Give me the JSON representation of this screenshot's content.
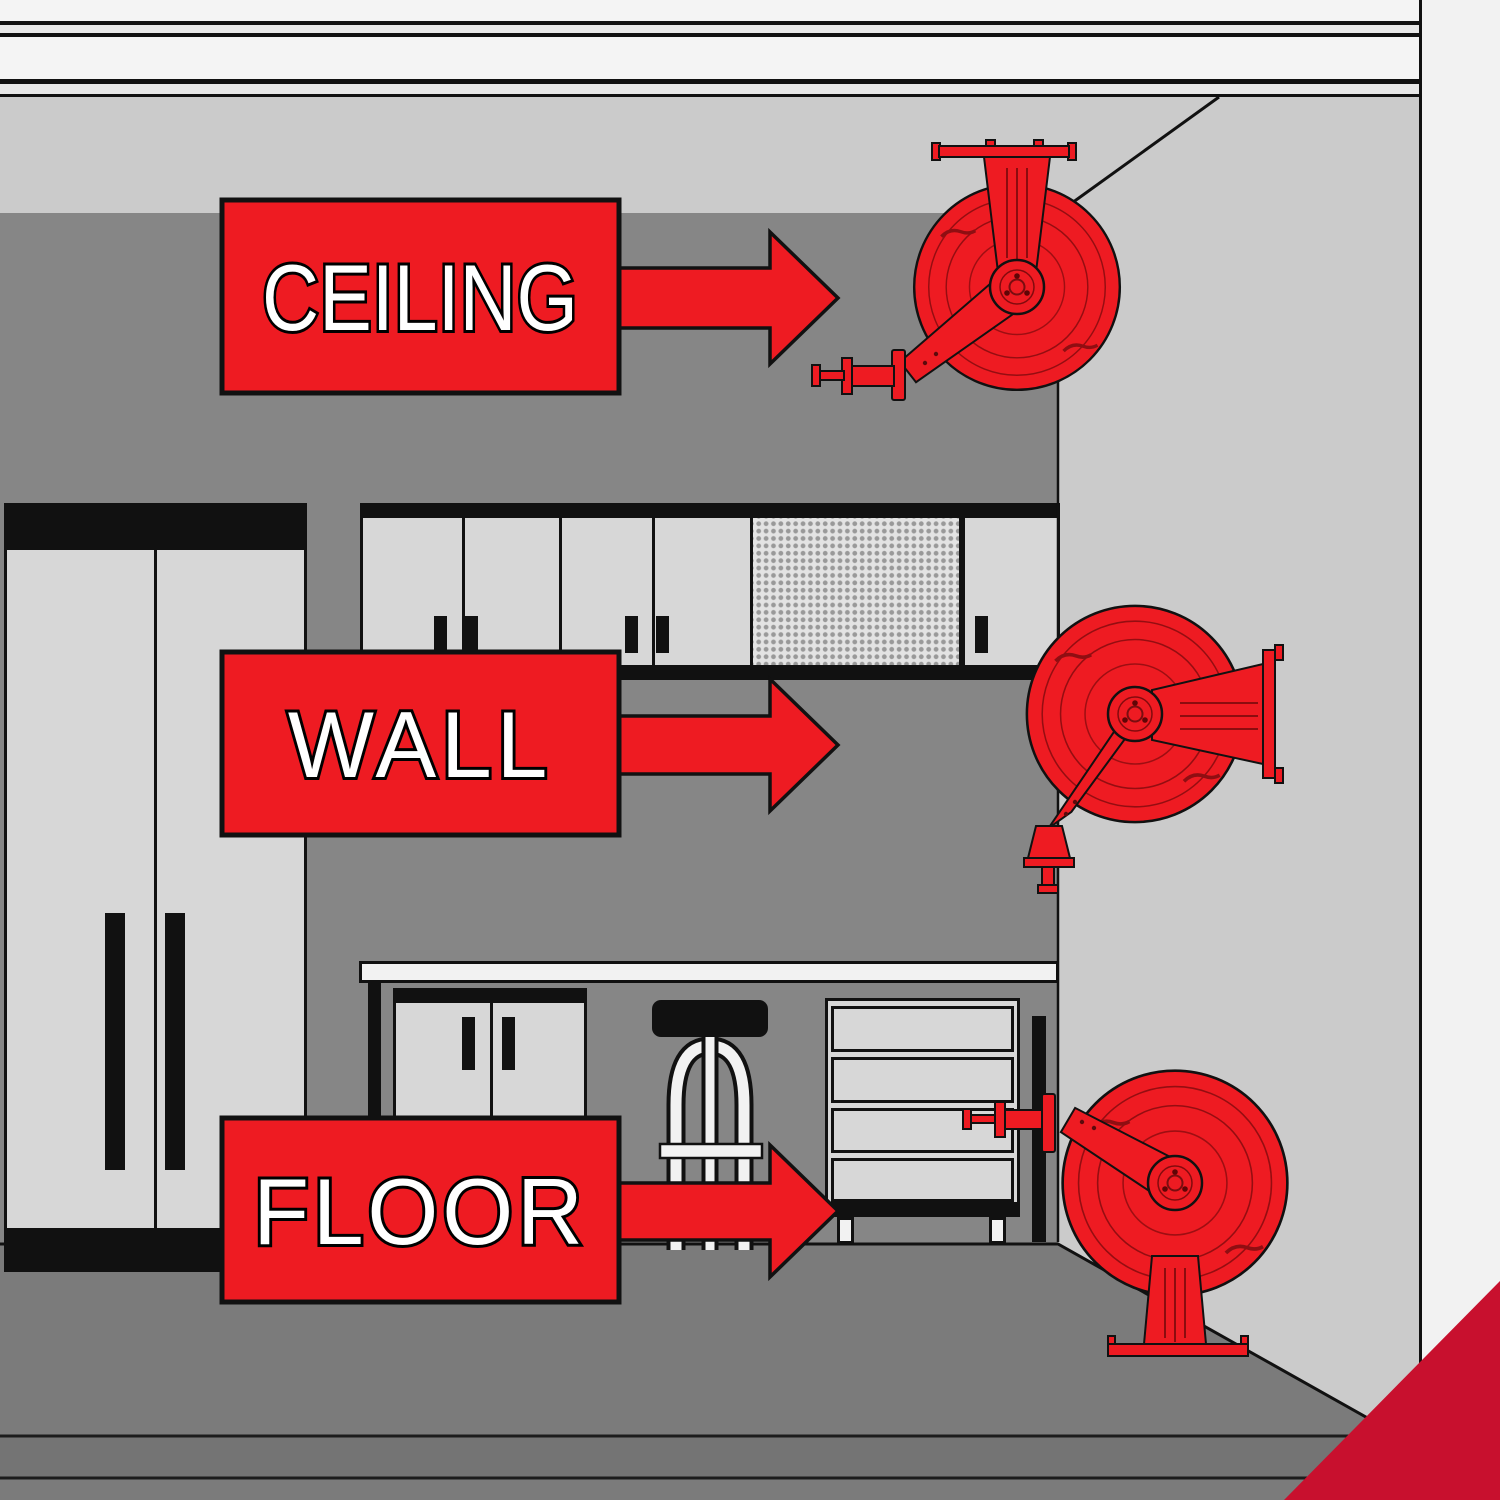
{
  "page": {
    "type": "product-mounting-illustration",
    "subject": "Garage hose reel mounting positions"
  },
  "labels": {
    "ceiling": {
      "text": "CEILING"
    },
    "wall": {
      "text": "WALL"
    },
    "floor": {
      "text": "FLOOR"
    }
  },
  "icons": {
    "ceiling_reel": "hose-reel-ceiling-mount",
    "wall_reel": "hose-reel-wall-mount",
    "floor_reel": "hose-reel-floor-mount",
    "arrow": "arrow-right"
  },
  "colors": {
    "label_red": "#ee1b22",
    "corner_accent_red": "#c8102e",
    "back_wall_gray": "#868686",
    "side_wall_gray": "#cbcbcb",
    "floor_gray": "#7b7b7b",
    "cabinet_gray": "#d7d7d7",
    "pegboard_gray": "#e3e3e3",
    "countertop_white": "#f2f2f2",
    "outline_black": "#111111",
    "margin_white": "#f2f2f2"
  }
}
